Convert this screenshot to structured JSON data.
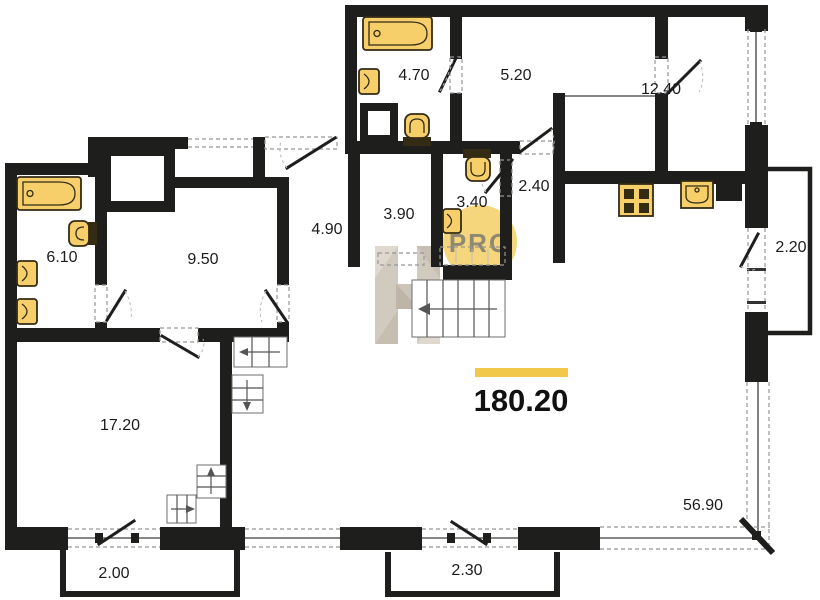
{
  "floorplan": {
    "total_area": {
      "value": "180.20"
    },
    "watermark": {
      "text": "PRO"
    },
    "rooms": [
      {
        "name": "bathroom-top",
        "area": "4.70"
      },
      {
        "name": "room-top-middle",
        "area": "5.20"
      },
      {
        "name": "room-top-right",
        "area": "12.40"
      },
      {
        "name": "hall-small",
        "area": "2.40"
      },
      {
        "name": "wc-small",
        "area": "3.40"
      },
      {
        "name": "laundry",
        "area": "3.90"
      },
      {
        "name": "hallway",
        "area": "4.90"
      },
      {
        "name": "room-middle-left",
        "area": "9.50"
      },
      {
        "name": "bathroom-left",
        "area": "6.10"
      },
      {
        "name": "room-bottom-left",
        "area": "17.20"
      }
    ],
    "dimensions": [
      {
        "name": "balcony-right",
        "value": "2.20"
      },
      {
        "name": "terrace",
        "value": "56.90"
      },
      {
        "name": "balcony-bottom-left",
        "value": "2.00"
      },
      {
        "name": "balcony-bottom-middle",
        "value": "2.30"
      }
    ],
    "colors": {
      "wall": "#1e1e1c",
      "fixture": "#f6cf6b",
      "fixture_dark": "#342b14",
      "accent": "#f2c84b",
      "watermark_circle": "#f5d67c",
      "watermark_text": "#8f8872",
      "watermark_logo": "#cdc5b8",
      "text": "#1c1c1c"
    }
  }
}
